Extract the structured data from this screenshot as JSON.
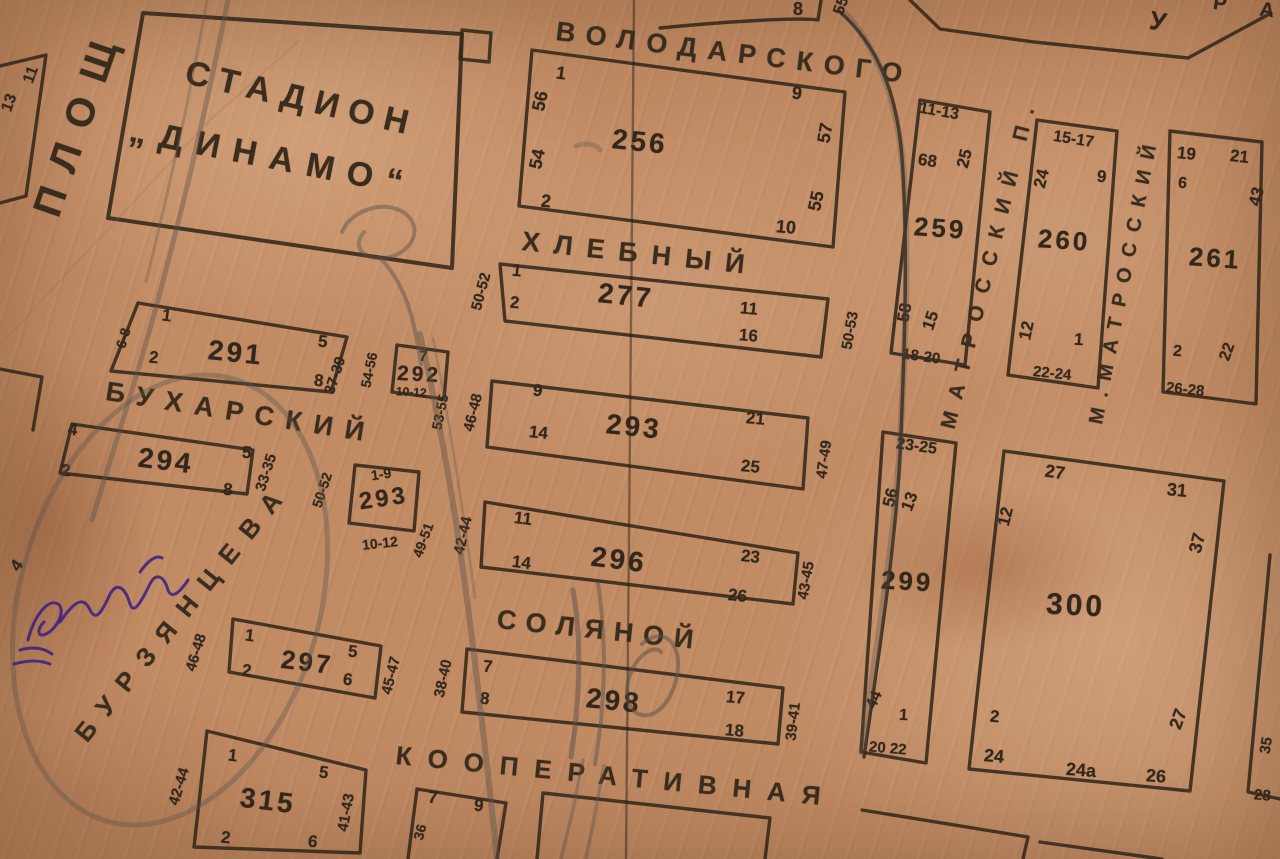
{
  "map": {
    "stadium": {
      "line1": "СТАДИОН",
      "line2": "„ДИНАМО“"
    },
    "streets": {
      "volodarskogo": "ВОЛОДАРСКОГО",
      "khlebny": "ХЛЕБНЫЙ",
      "bukharsky": "БУХАРСКИЙ",
      "solyanoy": "СОЛЯНОЙ",
      "kooperativnaya": "КООПЕРАТИВНАЯ",
      "matrossky": "МАТРОССКИЙ П.",
      "m_matrossky": "М.МАТРОССКИЙ",
      "burzyantseva": "БУРЗЯНЦЕВА",
      "ploshch": "ПЛОЩ"
    },
    "blocks": {
      "b256": {
        "num": "256",
        "tl": "1",
        "l1": "56",
        "l2": "54",
        "bl": "2",
        "tr": "9",
        "r": "57",
        "br": "10",
        "rb": "55"
      },
      "b277": {
        "num": "277",
        "tl": "1",
        "l": "2",
        "r": "11",
        "br": "16",
        "out_l": "50-52",
        "out_r": "50-53"
      },
      "b259": {
        "num": "259",
        "top": "11-13",
        "l": "68",
        "r": "25",
        "b1": "58",
        "b2": "15",
        "bottom": "18-20"
      },
      "b260": {
        "num": "260",
        "top": "15-17",
        "l": "24",
        "r": "9",
        "b1": "12",
        "b2": "1",
        "bottom": "22-24"
      },
      "b261": {
        "num": "261",
        "t1": "19",
        "t2": "21",
        "l": "6",
        "r": "43",
        "b1": "2",
        "b2": "22",
        "bottom": "26-28"
      },
      "b291": {
        "num": "291",
        "tl": "1",
        "bl": "2",
        "le": "6-8",
        "tr": "5",
        "br": "8",
        "out_r": "37-39"
      },
      "b292": {
        "num": "292",
        "top": "7",
        "bottom": "10-12",
        "out_l": "54-56",
        "out_r": "53-55"
      },
      "b293s": {
        "num": "293",
        "top": "1-9",
        "bottom": "10-12",
        "out_l": "50-52",
        "out_r": "49-51"
      },
      "b294": {
        "num": "294",
        "tl": "4",
        "bl": "2",
        "tr": "5",
        "br": "8",
        "out_r": "33-35"
      },
      "b293": {
        "num": "293",
        "tl": "9",
        "l": "14",
        "tr": "21",
        "br": "25",
        "out_l": "46-48",
        "out_r": "47-49"
      },
      "b296": {
        "num": "296",
        "tl": "11",
        "l": "14",
        "tr": "23",
        "br": "26",
        "out_l": "42-44",
        "out_r": "43-45"
      },
      "b298": {
        "num": "298",
        "tl": "7",
        "l": "8",
        "tr": "17",
        "br": "18",
        "out_l": "38-40",
        "out_r": "39-41"
      },
      "b297": {
        "num": "297",
        "tl": "1",
        "bl": "2",
        "tr": "5",
        "br": "6",
        "out_l": "46-48",
        "out_r": "45-47"
      },
      "b315": {
        "num": "315",
        "tl": "1",
        "tr": "5",
        "bl": "2",
        "br": "6",
        "out_l": "42-44",
        "out_r": "41-43"
      },
      "b299": {
        "num": "299",
        "top": "23-25",
        "l": "56",
        "r": "13",
        "b1": "44",
        "b2": "1",
        "bottom": "20 22"
      },
      "b300": {
        "num": "300",
        "tl": "27",
        "tr": "31",
        "l": "12",
        "r": "37",
        "bl2": "2",
        "bl": "24",
        "bc": "24а",
        "br": "26",
        "rb": "27"
      }
    },
    "fragments": {
      "top_8": "8",
      "top_55": "55",
      "top_u": "У",
      "top_ra": "Р А",
      "left_11": "11",
      "left_13": "13",
      "left_4": "4",
      "bot_7": "7",
      "bot_9": "9",
      "bot_36": "36",
      "right_35": "35",
      "right_28": "28"
    },
    "colors": {
      "paper": "#c18b64",
      "ink": "#33281b",
      "pencil": "#57504a",
      "violet": "#3f2180"
    }
  }
}
